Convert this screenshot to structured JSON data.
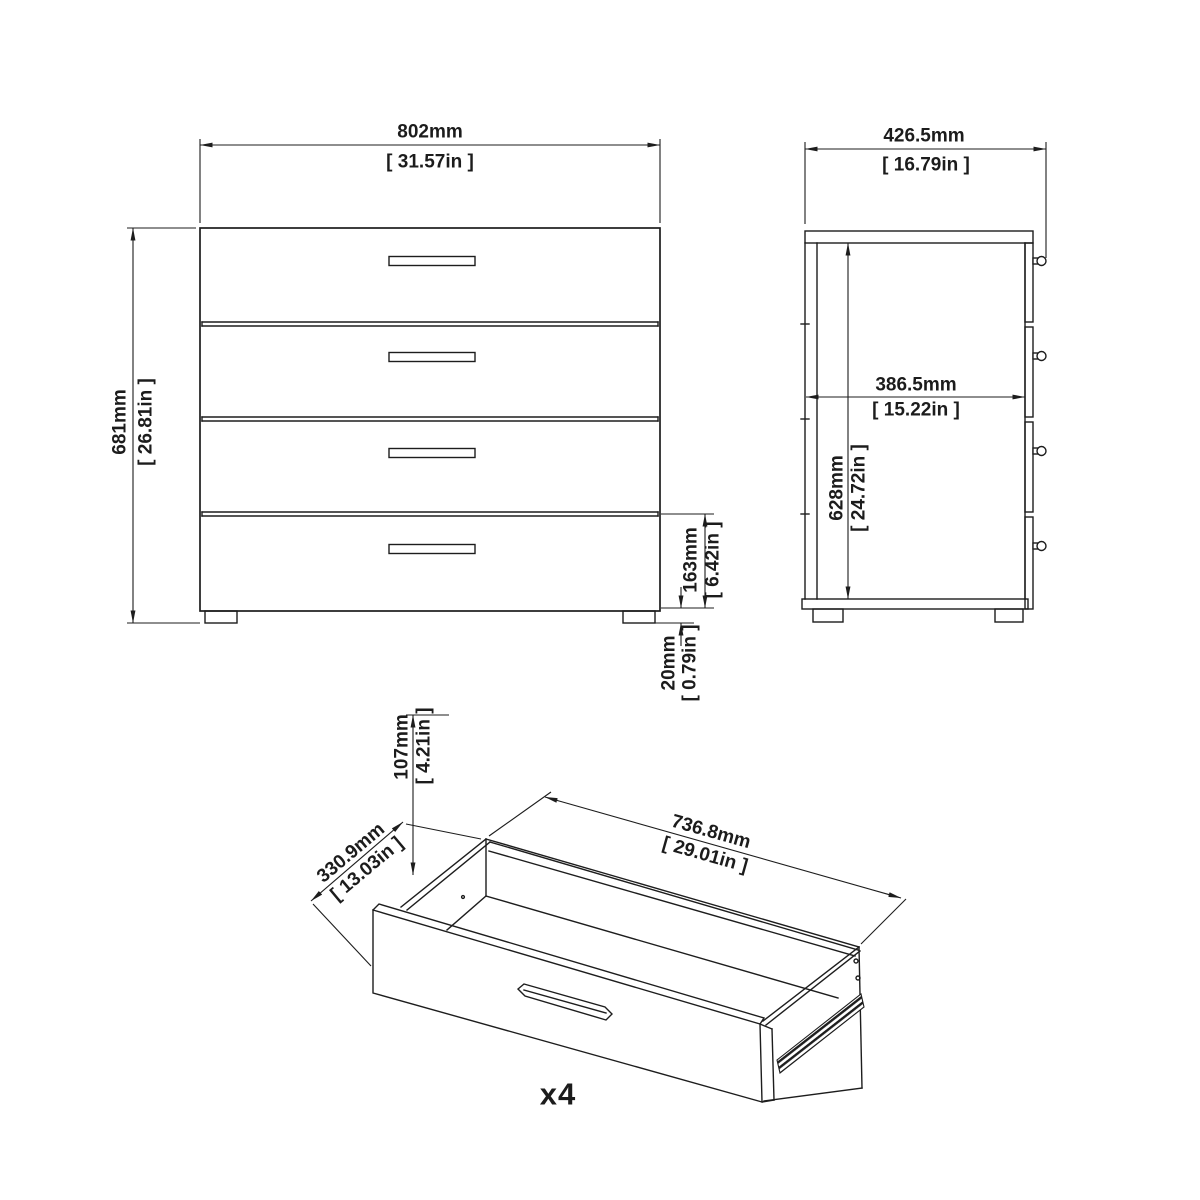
{
  "diagram": {
    "front_view": {
      "width": {
        "metric": "802mm",
        "imperial": "[ 31.57in ]"
      },
      "height": {
        "metric": "681mm",
        "imperial": "[ 26.81in ]"
      },
      "bottom_drawer_height": {
        "metric": "163mm",
        "imperial": "[ 6.42in ]"
      },
      "foot_height": {
        "metric": "20mm",
        "imperial": "[ 0.79in ]"
      }
    },
    "side_view": {
      "depth": {
        "metric": "426.5mm",
        "imperial": "[ 16.79in ]"
      },
      "interior_depth": {
        "metric": "386.5mm",
        "imperial": "[ 15.22in ]"
      },
      "interior_height": {
        "metric": "628mm",
        "imperial": "[ 24.72in ]"
      }
    },
    "drawer_view": {
      "interior_height": {
        "metric": "107mm",
        "imperial": "[ 4.21in ]"
      },
      "depth": {
        "metric": "330.9mm",
        "imperial": "[ 13.03in ]"
      },
      "width": {
        "metric": "736.8mm",
        "imperial": "[ 29.01in ]"
      },
      "quantity": "x4"
    }
  },
  "colors": {
    "line": "#1d1d1d",
    "background": "#ffffff"
  }
}
